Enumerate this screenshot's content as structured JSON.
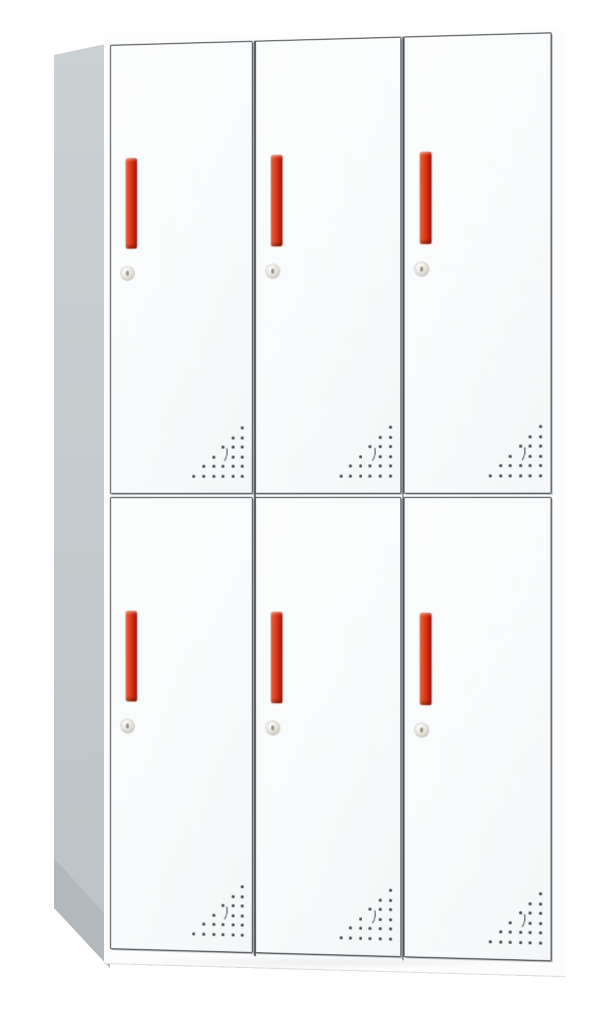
{
  "scene": {
    "description": "Product photo of a white steel 6-door storage locker with red handles, viewed from the front-left at a slight angle on a plain white background",
    "background_color": "#ffffff"
  },
  "cabinet": {
    "type": "6-door-metal-locker",
    "rows": 2,
    "columns": 3,
    "door_count": 6,
    "colors": {
      "body_white": "#fdfdfe",
      "door_face": "#f8fafb",
      "door_outline": "#3e4347",
      "side_panel": "#cbd0d3",
      "side_panel_shade": "#b2b8bb",
      "handle_red": "#e03a1a",
      "handle_red_light": "#f0653a",
      "handle_red_dark": "#a31408",
      "lock_face": "#e4e1d8",
      "vent_dot": "#3b4045"
    },
    "door": {
      "handle": {
        "style": "vertical-recessed-bar",
        "color_name": "red-orange"
      },
      "lock": {
        "style": "round-cam-lock",
        "keyhole": true
      },
      "vent": {
        "shape": "right-triangle-dot-grid",
        "rows": 6,
        "dot_spacing": 9.6,
        "dot_size": 3,
        "width": 51,
        "crescent": true,
        "crescent_row": 3,
        "crescent_skip_col": 2
      }
    }
  }
}
